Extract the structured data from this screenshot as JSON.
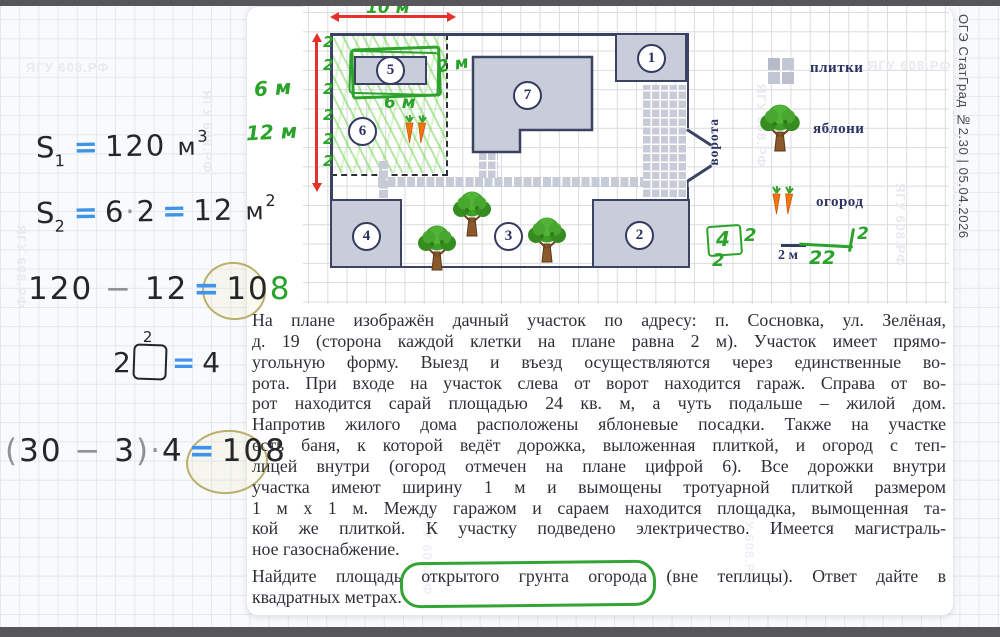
{
  "watermark": "ЯГУ 608.РФ",
  "sidebar": {
    "label": "ОГЭ СтатГрад №2.30 | 05.04.2026"
  },
  "notes": {
    "eq1": {
      "s": "S",
      "sub": "1",
      "eq": "=",
      "val": "120",
      "unit": "м",
      "sup": "3"
    },
    "eq2": {
      "s": "S",
      "sub": "2",
      "eq1": "=",
      "a": "6",
      "dot": "·",
      "b": "2",
      "eq2": "=",
      "val": "12",
      "unit": "м",
      "sup": "2"
    },
    "eq3": {
      "a": "120",
      "minus": "−",
      "b": "12",
      "eq": "=",
      "res_black": "10",
      "res_green": "8"
    },
    "eq4": {
      "a": "2",
      "sup": "2",
      "eq": "=",
      "val": "4"
    },
    "eq5": {
      "open": "(",
      "a": "30",
      "minus": "−",
      "b": "3",
      "close": ")",
      "dot": "·",
      "c": "4",
      "eq": "=",
      "val": "108"
    }
  },
  "plan": {
    "dim_width": "10 м",
    "dim_left_a": "6 м",
    "dim_left_b": "12 м",
    "cell_marks": [
      "2",
      "2",
      "2",
      "2",
      "2",
      "2"
    ],
    "bld5_width": "2 м",
    "bld5_depth": "6 м",
    "numbers": [
      "1",
      "2",
      "3",
      "4",
      "5",
      "6",
      "7"
    ],
    "gate_label": "ворота"
  },
  "legend": {
    "tiles": "плитки",
    "apples": "яблони",
    "garden": "огород",
    "scale": "2 м",
    "notes": {
      "boxed": "4",
      "beside": "2",
      "under_box": "2",
      "tick_num": "2",
      "under_scale": "22"
    }
  },
  "problem": {
    "para1": [
      "На плане изображён дачный участок по адресу: п. Сосновка, ул. Зелёная,",
      "д. 19 (сторона каждой клетки на плане равна 2 м). Участок имеет прямо-",
      "угольную форму. Выезд и въезд осуществляются через единственные во-",
      "рота. При входе на участок слева от ворот находится гараж. Справа от во-",
      "рот находится сарай площадью 24 кв. м, а чуть подальше – жилой дом.",
      "Напротив жилого дома расположены яблоневые посадки. Также на участке",
      "есть баня, к которой ведёт дорожка, выложенная плиткой, и огород с теп-",
      "лицей внутри (огород отмечен на плане цифрой 6). Все дорожки внутри",
      "участка имеют ширину 1 м и вымощены тротуарной плиткой размером",
      "1 м х 1 м. Между гаражом и сараем находится площадка, вымощенная та-",
      "кой же плиткой. К участку подведено электричество. Имеется магистраль-",
      "ное газоснабжение."
    ],
    "para2": [
      "Найдите площадь открытого грунта огорода (вне теплицы). Ответ дайте в",
      "квадратных метрах."
    ]
  }
}
